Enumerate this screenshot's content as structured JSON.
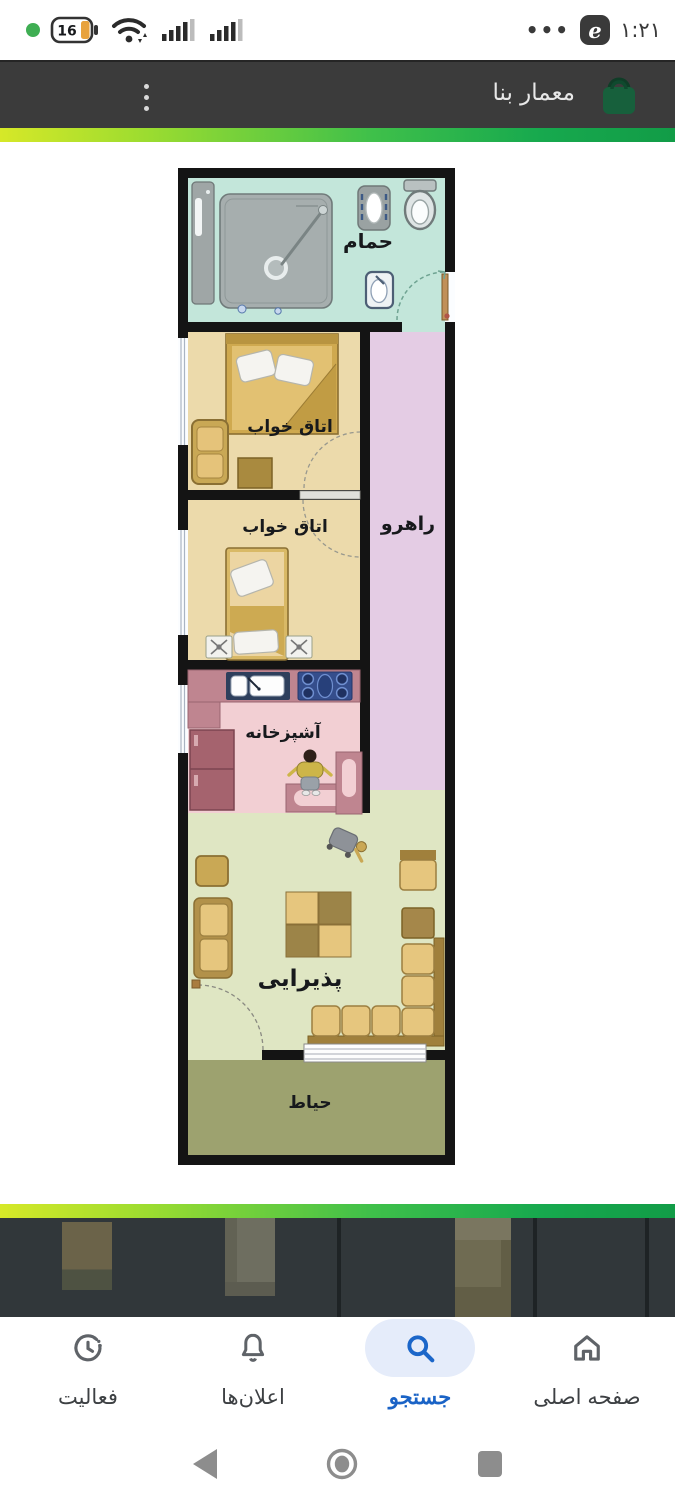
{
  "status_bar": {
    "time": "۱:۲۱",
    "battery_percent": "16",
    "more_dots": "•••",
    "app_badge_glyph": "e"
  },
  "header": {
    "title": "معمار بنا"
  },
  "accent": {
    "gradient_left": "#d6e828",
    "gradient_right": "#129c47",
    "header_bg": "#3b3b3b",
    "active_nav_color": "#1a63c6",
    "active_nav_bg": "#e5ecfa"
  },
  "floor_plan": {
    "rooms": [
      {
        "id": "bathroom",
        "label": "حمام",
        "color": "#c3e6da"
      },
      {
        "id": "bedroom-1",
        "label": "اتاق خواب",
        "color": "#ecdaab"
      },
      {
        "id": "bedroom-2",
        "label": "اتاق خواب",
        "color": "#ecdaab"
      },
      {
        "id": "hallway",
        "label": "راهرو",
        "color": "#e4cce4"
      },
      {
        "id": "kitchen",
        "label": "آشپزخانه",
        "color": "#f2cfd3"
      },
      {
        "id": "living-room",
        "label": "پذیرایی",
        "color": "#dfe6c3"
      },
      {
        "id": "yard",
        "label": "حیاط",
        "color": "#9da26f"
      }
    ]
  },
  "gallery": {
    "thumbnail_count": 3,
    "thumbnails": [
      "floor-plan-thumbnail-1",
      "floor-plan-thumbnail-2",
      "floor-plan-thumbnail-3"
    ]
  },
  "bottom_nav": {
    "items": [
      {
        "label": "فعالیت",
        "icon": "activity-clock-icon",
        "active": false
      },
      {
        "label": "اعلان‌ها",
        "icon": "bell-icon",
        "active": false
      },
      {
        "label": "جستجو",
        "icon": "search-icon",
        "active": true
      },
      {
        "label": "صفحه اصلی",
        "icon": "home-icon",
        "active": false
      }
    ]
  }
}
